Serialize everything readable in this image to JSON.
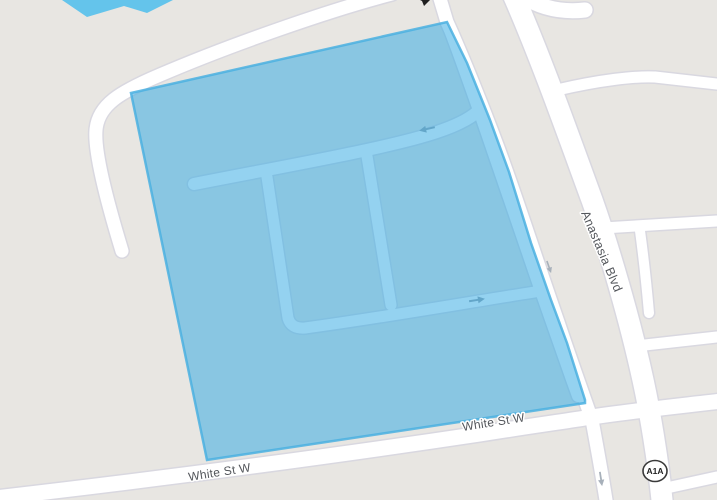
{
  "map": {
    "street_labels": {
      "anastasia_blvd": "Anastasia Blvd",
      "white_st_w": "White St W"
    },
    "route_shield": {
      "label": "A1A"
    },
    "colors": {
      "land": "#e8e6e2",
      "road_fill": "#ffffff",
      "road_casing": "#d9d8e0",
      "selection_fill": "#35aae2",
      "selection_outline": "#4bb0e0",
      "water": "#64c4eb",
      "label_text": "#54575c",
      "oneway_arrow": "#98a2ad"
    }
  }
}
